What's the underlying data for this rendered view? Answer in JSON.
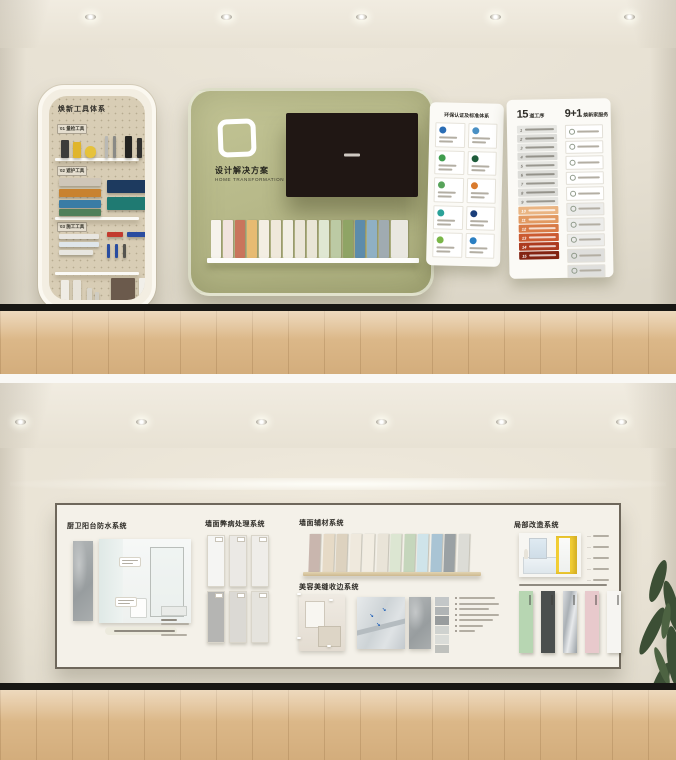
{
  "palette": {
    "wall": "#e7e1d4",
    "ceiling": "#efeadf",
    "panel_green": "#b5b787",
    "floor_wood": "#ddbb8e",
    "baseboard": "#181714",
    "cove_light": "#fffdf6"
  },
  "scene1": {
    "tool_panel": {
      "title": "焕新工具体系",
      "sections": [
        {
          "label": "01 量检工具"
        },
        {
          "label": "02 遮护工具"
        },
        {
          "label": "03 施工工具"
        }
      ],
      "blocks": [
        {
          "x": 12,
          "y": 44,
          "w": 8,
          "h": 18,
          "c": "#3c3c3a"
        },
        {
          "x": 24,
          "y": 46,
          "w": 8,
          "h": 16,
          "c": "#e0b52c"
        },
        {
          "x": 36,
          "y": 50,
          "w": 11,
          "h": 12,
          "c": "#e6c23a",
          "r": 6
        },
        {
          "x": 56,
          "y": 40,
          "w": 3,
          "h": 22,
          "c": "#b9b9b5"
        },
        {
          "x": 64,
          "y": 40,
          "w": 3,
          "h": 22,
          "c": "#8a8a86"
        },
        {
          "x": 76,
          "y": 40,
          "w": 7,
          "h": 22,
          "c": "#232321"
        },
        {
          "x": 88,
          "y": 42,
          "w": 5,
          "h": 20,
          "c": "#30302e"
        },
        {
          "x": 10,
          "y": 82,
          "w": 42,
          "h": 8,
          "c": "#cfc6b8"
        },
        {
          "x": 10,
          "y": 93,
          "w": 42,
          "h": 8,
          "c": "#c8822f"
        },
        {
          "x": 10,
          "y": 104,
          "w": 42,
          "h": 8,
          "c": "#3a7ca5"
        },
        {
          "x": 10,
          "y": 113,
          "w": 42,
          "h": 7,
          "c": "#4f7f5a"
        },
        {
          "x": 58,
          "y": 84,
          "w": 44,
          "h": 13,
          "c": "#1d3a5f"
        },
        {
          "x": 58,
          "y": 101,
          "w": 44,
          "h": 13,
          "c": "#1f7a72"
        },
        {
          "x": 10,
          "y": 138,
          "w": 40,
          "h": 5,
          "c": "#e8e6e0"
        },
        {
          "x": 10,
          "y": 146,
          "w": 40,
          "h": 5,
          "c": "#dfe6ea"
        },
        {
          "x": 10,
          "y": 154,
          "w": 34,
          "h": 5,
          "c": "#e8e6e0"
        },
        {
          "x": 58,
          "y": 136,
          "w": 16,
          "h": 5,
          "c": "#c23a2e"
        },
        {
          "x": 78,
          "y": 136,
          "w": 20,
          "h": 5,
          "c": "#2a4da0"
        },
        {
          "x": 58,
          "y": 148,
          "w": 3,
          "h": 14,
          "c": "#2a4da0"
        },
        {
          "x": 66,
          "y": 148,
          "w": 3,
          "h": 14,
          "c": "#2a4da0"
        },
        {
          "x": 74,
          "y": 148,
          "w": 3,
          "h": 14,
          "c": "#55544f"
        },
        {
          "x": 12,
          "y": 184,
          "w": 8,
          "h": 26,
          "c": "#efece4"
        },
        {
          "x": 24,
          "y": 184,
          "w": 8,
          "h": 26,
          "c": "#e7e3d9"
        },
        {
          "x": 38,
          "y": 192,
          "w": 5,
          "h": 18,
          "c": "#d9d5ca"
        },
        {
          "x": 46,
          "y": 196,
          "w": 4,
          "h": 14,
          "c": "#cfccc2"
        },
        {
          "x": 62,
          "y": 182,
          "w": 24,
          "h": 28,
          "c": "#6b5a4c"
        },
        {
          "x": 90,
          "y": 182,
          "w": 12,
          "h": 28,
          "c": "#f1efe9"
        }
      ]
    },
    "main_panel": {
      "title": "设计解决方案",
      "subtitle_en": "HOME TRANSFORMATION",
      "swatches": [
        "#f6f3ec",
        "#f1e3dd",
        "#c9755c",
        "#e7bb72",
        "#f3eee3",
        "#efe8da",
        "#f2efe4",
        "#ebe6d8",
        "#e9e5d6",
        "#dfe7d2",
        "#bccaa4",
        "#8fa465",
        "#5d8cab",
        "#8fb0c4",
        "#a0abb1",
        "#e9e7e0"
      ]
    },
    "cert_panel": {
      "title": "环保认证及标准体系",
      "logo_colors": [
        "#2a6db5",
        "#4a90c4",
        "#3f9d4e",
        "#1e5c3a",
        "#57a35a",
        "#d97b2e",
        "#2aa198",
        "#1b3f7a",
        "#7ab648",
        "#2b7fc2"
      ]
    },
    "process_panel": {
      "left_num": "15",
      "left_label": "道工序",
      "right_num": "9+1",
      "right_label": "焕新家服务",
      "step_colors": [
        "#e6e6e2",
        "#dcdcd8",
        "#e6e6e2",
        "#dcdcd8",
        "#e6e6e2",
        "#dcdcd8",
        "#e6e6e2",
        "#dcdcd8",
        "#e6e6e2",
        "#eab583",
        "#e29a62",
        "#d87a45",
        "#cb5a31",
        "#ac3a1f",
        "#832312"
      ],
      "service_bgs": [
        "#ffffff",
        "#ffffff",
        "#ffffff",
        "#ffffff",
        "#ffffff",
        "#ececea",
        "#ececea",
        "#ececea",
        "#dfdfdd",
        "#dfdfdd"
      ]
    }
  },
  "scene2": {
    "sections": [
      {
        "title": "厨卫阳台防水系统"
      },
      {
        "title": "墙面弊病处理系统"
      },
      {
        "title": "墙面辅材系统"
      },
      {
        "title": "美容美缝收边系统"
      },
      {
        "title": "局部改造系统"
      }
    ],
    "material_swatches": [
      "#c9b6ae",
      "#e6dac6",
      "#ddd2bf",
      "#efe9dd",
      "#f2ede2",
      "#e9e4d8",
      "#dce6d2",
      "#c5d6bc",
      "#cfe4ea",
      "#a9c4d4",
      "#9aa1a4",
      "#dcdcd6"
    ],
    "defect_boards": [
      "#f5f5f3",
      "#ebe9e5",
      "#efede9",
      "#b5b5b3",
      "#dbd9d4",
      "#e5e3dd"
    ],
    "grout_swatches": [
      "#c3c7c8",
      "#b0b4b5",
      "#989c9d",
      "#cfd2cf",
      "#dadcd8",
      "#bfc1bd"
    ],
    "reno_strips": [
      {
        "c": "#b7d6b2"
      },
      {
        "c": "#4b4f4e"
      },
      {
        "c": "#c0c3c6",
        "metal": true
      },
      {
        "c": "#e8c9cc"
      },
      {
        "c": "#f6f5f2"
      }
    ]
  }
}
